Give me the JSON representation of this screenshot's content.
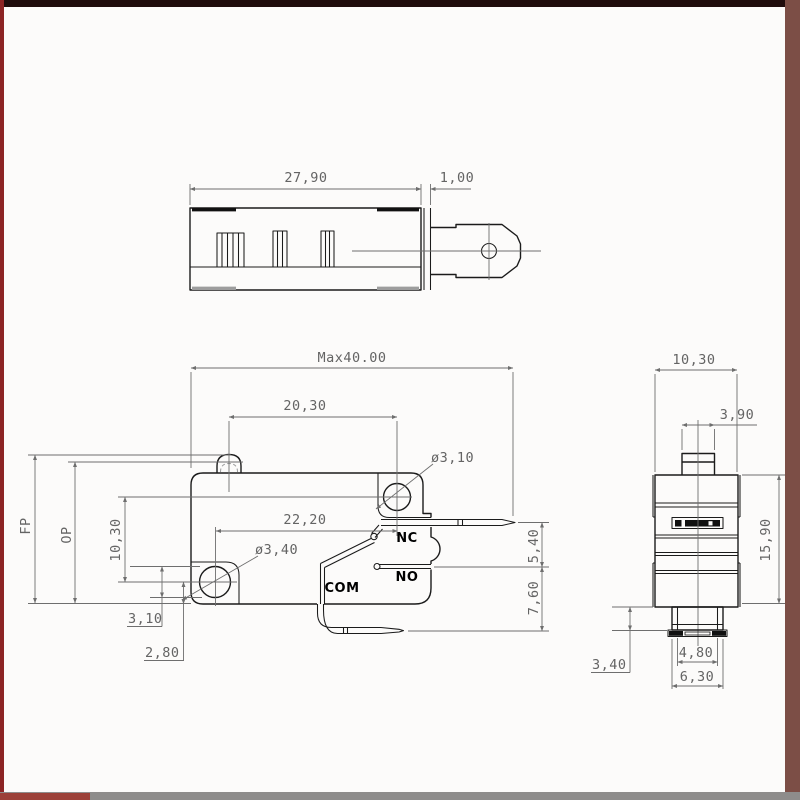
{
  "drawing": {
    "subject": "micro switch dimensional drawing, three orthographic views",
    "line_color": "#1b1b1b",
    "dimension_color": "#6e6e6e"
  },
  "frame": {
    "top": "#1f0c0c",
    "left": "#8c2424",
    "right": "#7c4e46",
    "bottom": "#8e8c8b",
    "bottom_left": "#9c4038"
  },
  "dims": {
    "top_body_length": "27,90",
    "top_cap_width": "1,00",
    "front_max_width": "Max40.00",
    "front_hole_span": "20,30",
    "front_top_hole_dia": "ø3,10",
    "front_terminal_span": "22,20",
    "front_bottom_hole_dia": "ø3,40",
    "front_free_position": "FP",
    "front_operating_position": "OP",
    "front_hole_vspan": "10,30",
    "front_hole_to_bottom": "3,10",
    "front_hole_center_to_bottom": "2,80",
    "front_nc_no_gap": "5,40",
    "front_no_com_gap": "7,60",
    "label_nc": "NC",
    "label_no": "NO",
    "label_com": "COM",
    "side_body_width": "10,30",
    "side_plunger_width": "3,90",
    "side_body_height": "15,90",
    "side_terminal_step": "3,40",
    "side_terminal_inner_width": "4,80",
    "side_terminal_outer_width": "6,30"
  }
}
